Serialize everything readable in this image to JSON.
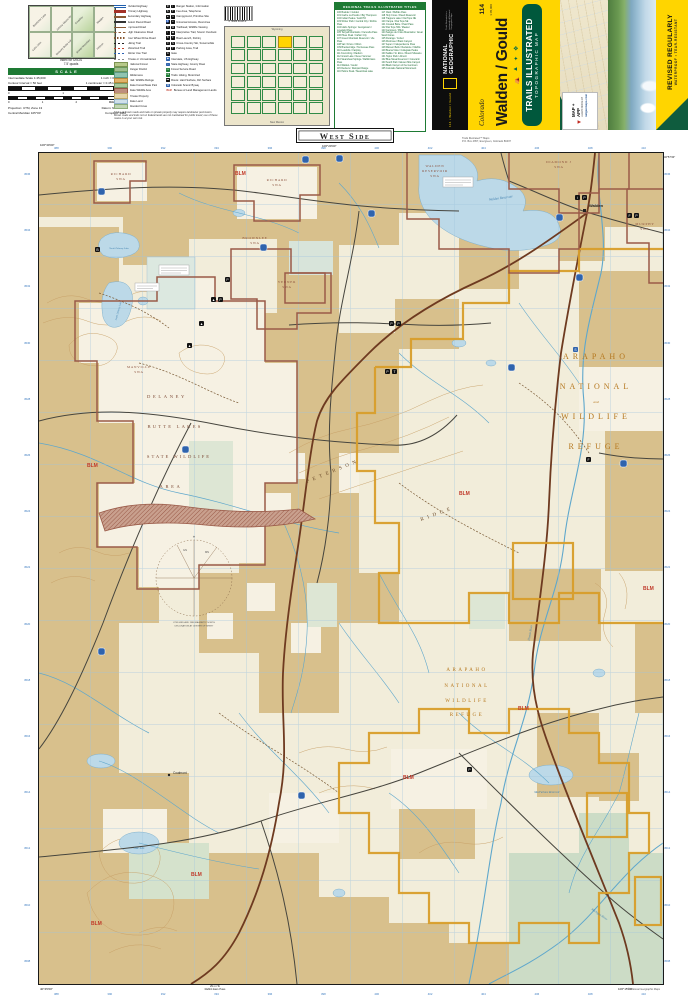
{
  "colors": {
    "natgeo_yellow": "#ffd500",
    "ti_green": "#00583c",
    "header_green": "#1e7a34",
    "blm_tan": "#d8c08c",
    "refuge_gold": "#d89e2b",
    "swa_brown": "#9a5a48",
    "water_blue": "#bcd9e8",
    "blm_red": "#c03a2a",
    "label_gold": "#b5771e"
  },
  "header": {
    "quad_index": {
      "caption_line1": "Index for USGS",
      "caption_line2": "7.5' quads",
      "quads": [
        "Boettcher Lake",
        "Johnny Moore Mountain",
        "Cowdrey",
        "Walden",
        "Lake John",
        "Delaney Butte Lakes",
        "Sheep Mountain",
        "Hebron"
      ]
    },
    "scale": {
      "title": "SCALE",
      "r1l": "Intermediate Scale 1:45,000",
      "r1r": "1 inch = 0.71 miles",
      "r2l": "Contour Interval = 50 feet",
      "r2r": "1 centimeter = 0.45 kilometers",
      "mi0": "0",
      "mi1": "1",
      "mi2": "Miles 2",
      "km0": "0",
      "km1": "1",
      "km2": "2",
      "km3": "Kilometers 3",
      "p1l": "Projection: UTM, Zone 13",
      "p1r": "Datum: NAD 1927",
      "p2l": "Central Meridian 105°00'",
      "p2r": "Compiled: 1986"
    },
    "legend": {
      "line_items": [
        {
          "label": "Divided Highway",
          "cls": "sw-divided"
        },
        {
          "label": "Primary Highway",
          "cls": "sw-primary"
        },
        {
          "label": "Secondary Highway",
          "cls": "sw-secondary"
        },
        {
          "label": "Select Paved Road",
          "cls": "sw-paved"
        },
        {
          "label": "Improved Road",
          "cls": "sw-improved"
        },
        {
          "label": "High Clearance Road",
          "cls": "sw-highclear"
        },
        {
          "label": "Four Wheel Drive Road",
          "cls": "sw-4wd"
        },
        {
          "label": "Hiking Trail",
          "cls": "sw-hiking"
        },
        {
          "label": "Motorized Trail",
          "cls": "sw-moto"
        },
        {
          "label": "Winter Use Trail",
          "cls": "sw-winter"
        },
        {
          "label": "Private or Unmaintained",
          "cls": "sw-unmaint"
        },
        {
          "label": "National Forest",
          "cls": "sw-band-nf"
        },
        {
          "label": "Ranger District",
          "cls": "sw-band-rd"
        },
        {
          "label": "Wilderness",
          "cls": "sw-band-wild"
        },
        {
          "label": "Natl. Wildlife Refuge",
          "cls": "sw-band-nwr"
        },
        {
          "label": "State Forest/State Park",
          "cls": "sw-band-sf"
        },
        {
          "label": "State Wildlife Area",
          "cls": "sw-band-swa"
        },
        {
          "label": "Private Property",
          "cls": "sw-band-pp"
        },
        {
          "label": "State Land",
          "cls": "sw-band-sl"
        },
        {
          "label": "Wooded Cover",
          "cls": "sw-band-wc"
        }
      ],
      "icon_items": [
        {
          "b1": "R",
          "b2": "i",
          "label": "Ranger Station, Information"
        },
        {
          "b1": "$",
          "b2": "T",
          "label": "Fee Area, Telephone"
        },
        {
          "b1": "▲",
          "b2": "∧",
          "label": "Campground, Primitive Site"
        },
        {
          "b1": "♿",
          "b2": "≡",
          "label": "Universal Access, Rest Area"
        },
        {
          "b1": "H",
          "b2": "W",
          "label": "Trailhead, Wildlife Viewing"
        },
        {
          "b1": "i",
          "b2": "◉",
          "label": "Interpretive Trail, Scenic Overlook"
        },
        {
          "b1": "B",
          "b2": "F",
          "label": "Boat Launch, Fishing"
        },
        {
          "b1": "X",
          "b2": "S",
          "label": "Cross-Country Ski, Snowmobile"
        },
        {
          "b1": "P",
          "b2": "T",
          "label": "Parking Area, Trail"
        },
        {
          "b1": "G",
          "label": "Gate"
        },
        {
          "b1": "◆",
          "bcls": "b-blue",
          "label": "Interstate, US Highway"
        },
        {
          "b1": "○",
          "bcls": "b-blue",
          "label": "State Highway, County Road"
        },
        {
          "b1": "▭",
          "bcls": "b-green",
          "label": "Forest Service Road"
        },
        {
          "b1": "mi",
          "bcls": "b-green",
          "label": "Trails: Hiking, Motorized"
        },
        {
          "b1": "▬",
          "label": "Route: Hard Surface, Dirt Surface"
        },
        {
          "b1": "⌘",
          "bcls": "b-blue",
          "label": "Colorado Scenic Byway"
        },
        {
          "b1": "BLM",
          "bcls": "b-red",
          "label": "Bureau of Land Management Lands"
        }
      ],
      "footnote": "Status of brown roads and trails on private property may require landowner permission. Brown roads and trails not on federal lands are not maintained for public travel; use of these routes is at your own risk."
    },
    "barcode": "0 78989 61145 2",
    "state_map": {
      "top": "Wyoming",
      "bottom": "New Mexico"
    },
    "titles": {
      "title": "REGIONAL TRAILS ILLUSTRATED TITLES",
      "items": [
        "100 Boulder / Golden",
        "101 Cache La Poudre / Big Thompson",
        "102 Indian Peaks / Gold Hill",
        "103 Winter Park / Central City / Rollins Pass",
        "104 Idaho Springs / Georgetown / Loveland Pass",
        "105 Tarryall Mountains / Kenosha Pass",
        "106 Pikes Peak / Cañon City",
        "107 Green Mountain Reservoir / Ute Pass",
        "108 Vail / Frisco / Dillon",
        "109 Breckenridge / Tennessee Pass",
        "110 Leadville / Fairplay",
        "111 Kremmling / Radium",
        "112 Grand Lake / Never Summer",
        "113 Steamboat Springs / Rabbit Ears Pass",
        "114 Walden / Gould",
        "115 Deckers / Rampart Range",
        "116 Hahns Peak / Steamboat Lake",
        "117 Clark / Buffalo Pass",
        "118 Holy Cross / Ruedi Reservoir",
        "119 Trappers Lake / Flat Tops NE",
        "120 Yampa / Flat Tops SE",
        "121 Crested Butte / Pearl Pass",
        "122 Flat Tops NW / Meeker",
        "123 Gunnison / Pitkin",
        "124 Sangre de Cristo Mountains / Great Sand Dunes",
        "125 Durango / Cortez",
        "126 Montrose / Black Canyon",
        "127 Aspen / Independence Pass",
        "128 Maroon Bells / Redstone / Marble",
        "129 Buena Vista / Collegiate Peaks",
        "130 Salida / St. Elmo / Mount Shavano",
        "131 Taylor Park / Almont",
        "132 Blue Mesa Reservoir / Curecanti",
        "133 South Park / Eleven Mile Canyon",
        "134 Black Canyon of the Gunnison",
        "135 Colorado National Monument"
      ]
    },
    "cover": {
      "spine": {
        "series_text": "114 • Walden / Gould",
        "brand_line1": "NATIONAL",
        "brand_line2": "GEOGRAPHIC",
        "footnote": "Trails Illustrated is a trademark of National Geographic Maps"
      },
      "state": "Colorado",
      "number": "114",
      "scale_text": "1:45,000",
      "title": "Walden / Gould",
      "icons": [
        {
          "name": "camping-icon",
          "glyph": "⛺"
        },
        {
          "name": "hiking-icon",
          "glyph": "▲"
        },
        {
          "name": "fishing-icon",
          "glyph": "✦"
        },
        {
          "name": "boating-icon",
          "glyph": "❖"
        }
      ],
      "badge_line1": "TRAILS ILLUSTRATED",
      "badge_line2": "TOPOGRAPHIC MAP",
      "mapapp": {
        "l1": "MAP + APP",
        "l2": "LEARN MORE AT",
        "l3": "natgeomaps.com"
      },
      "ribbon": {
        "l1": "REVISED REGULARLY",
        "l2": "WATERPROOF • TEAR-RESISTANT"
      }
    }
  },
  "map": {
    "labels": {
      "west_side": "West Side",
      "top_lon": "106°20'00\"",
      "corner_nw": "106°30'00\"",
      "corner_se": "106°15'00\"",
      "corner_sw": "40°45'00\"",
      "corner_ne": "40°57'30\"",
      "publisher1": "Trails Illustrated™ Maps",
      "publisher2": "P.O. Box 4357, Evergreen, Colorado 80437",
      "copyright": "© National Geographic Maps",
      "refuge1": [
        "ARAPAHO",
        "NATIONAL",
        "and",
        "WILDLIFE",
        "REFUGE"
      ],
      "refuge2": [
        "ARAPAHO",
        "NATIONAL",
        "WILDLIFE",
        "REFUGE"
      ],
      "delaney": [
        "DELANEY",
        "BUTTE LAKES",
        "STATE WILDLIFE",
        "AREA"
      ],
      "richard": "RICHARD",
      "brownlee": "BROWNLEE",
      "manville": "MANVILLE",
      "verner": "VERNER",
      "walden_res_swa": [
        "WALDEN",
        "RESERVOIR",
        "SWA"
      ],
      "diamond_j": "DIAMOND J",
      "murphy": "MURPHY",
      "swa": "SWA",
      "peterson": "PETERSON",
      "ridge": "RIDGE",
      "blm": "BLM",
      "walden_town": "Walden",
      "coalmont": "Coalmont",
      "north_delaney": "North Delaney Lake",
      "south_delaney": "South Delaney Lake",
      "walden_res": "Walden Reservoir",
      "macfarlane": "MacFarlane Reservoir",
      "lake_john": "Lake John",
      "illinois": "Illinois River",
      "michigan": "Michigan River",
      "decl_star": "✶",
      "decl_gn": "GN",
      "decl_mn": "MN",
      "decl1": "UTM GRID AND 1986 MAGNETIC NORTH",
      "decl2": "DECLINATION AT CENTER OF SHEET",
      "rabbit1": "29 mi To",
      "rabbit2": "Rabbit Ears Pass"
    },
    "margin": {
      "eastings": [
        "388",
        "390",
        "392",
        "394",
        "396",
        "398",
        "400",
        "402",
        "404",
        "406",
        "408",
        "410"
      ],
      "northings": [
        "4536",
        "4534",
        "4532",
        "4530",
        "4528",
        "4526",
        "4524",
        "4522",
        "4520",
        "4518",
        "4516",
        "4514",
        "4512",
        "4510",
        "4508"
      ]
    }
  }
}
